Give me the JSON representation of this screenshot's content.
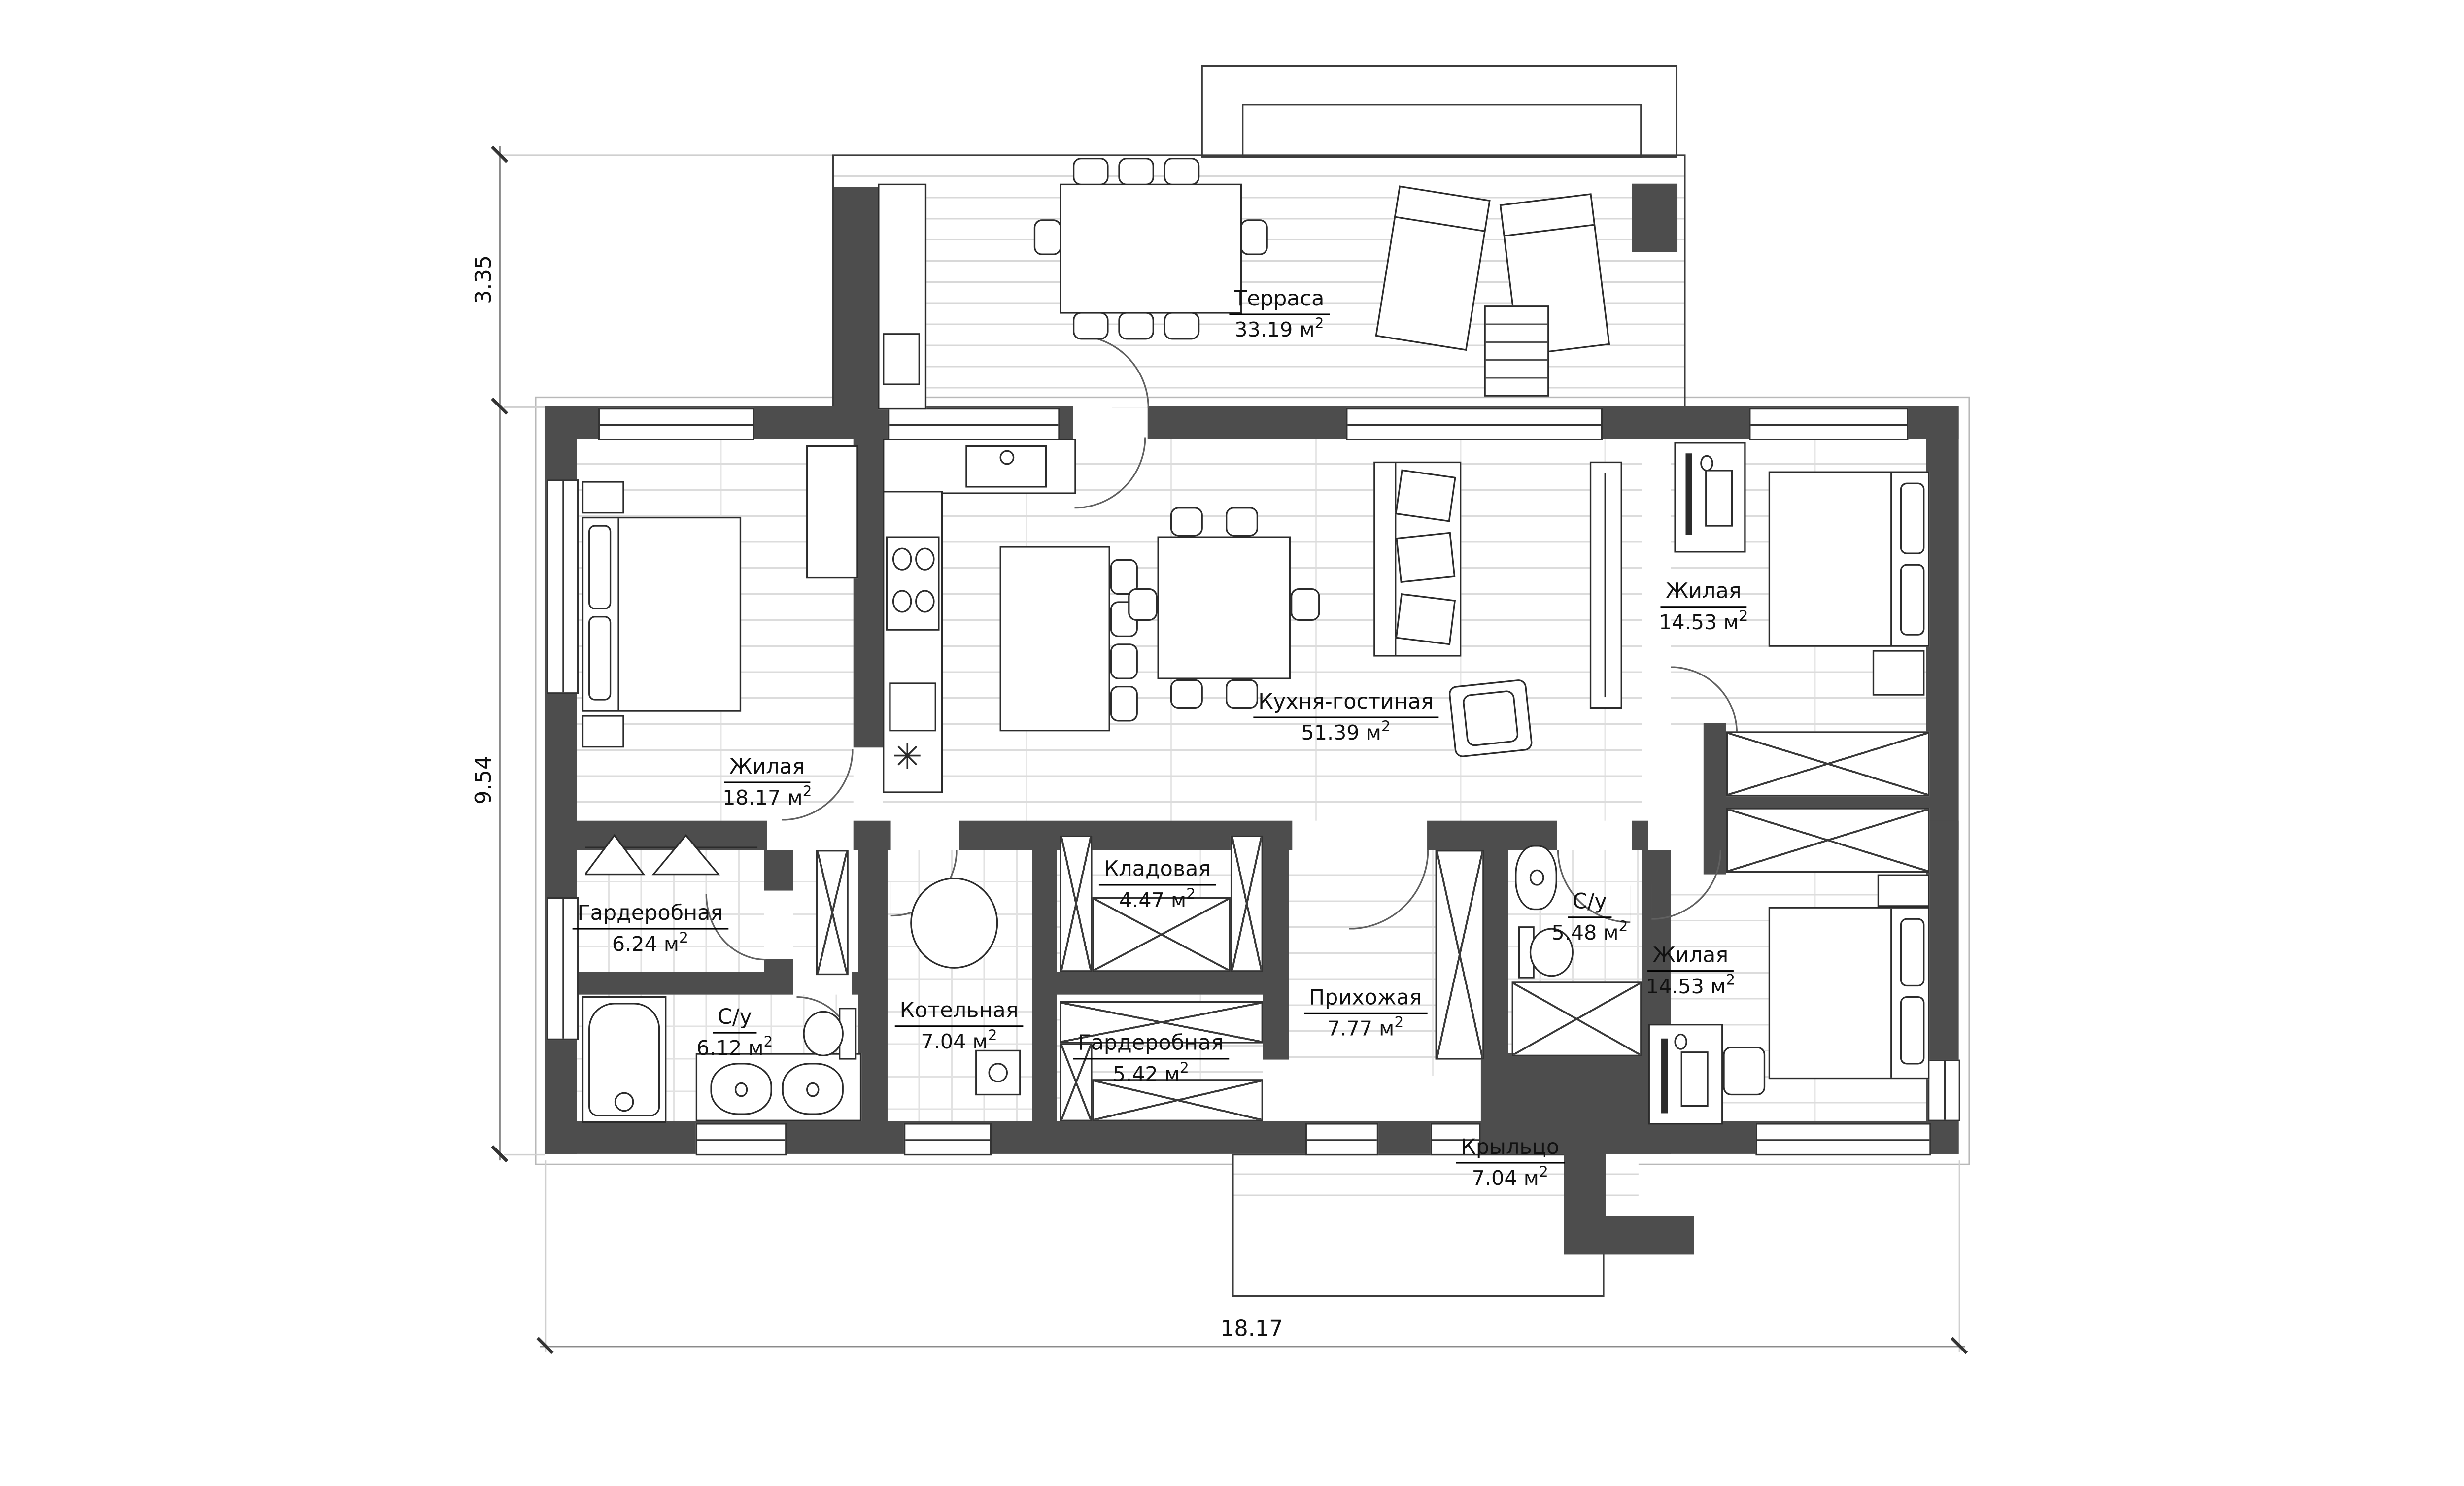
{
  "plan": {
    "title": "floor-plan",
    "units": {
      "area": "м",
      "sup": "2"
    },
    "rooms": [
      {
        "name": "Терраса",
        "area": "33.19"
      },
      {
        "name": "Кухня-гостиная",
        "area": "51.39"
      },
      {
        "name": "Жилая",
        "area": "18.17"
      },
      {
        "name": "Жилая",
        "area": "14.53"
      },
      {
        "name": "Жилая",
        "area": "14.53"
      },
      {
        "name": "Гардеробная",
        "area": "6.24"
      },
      {
        "name": "С/у",
        "area": "6.12"
      },
      {
        "name": "Котельная",
        "area": "7.04"
      },
      {
        "name": "Кладовая",
        "area": "4.47"
      },
      {
        "name": "Гардеробная",
        "area": "5.42"
      },
      {
        "name": "Прихожая",
        "area": "7.77"
      },
      {
        "name": "С/у",
        "area": "5.48"
      },
      {
        "name": "Крыльцо",
        "area": "7.04"
      }
    ],
    "dimensions": {
      "terrace_depth": "3.35",
      "house_depth": "9.54",
      "house_width": "18.17"
    },
    "icons": {
      "snowflake": "✳"
    },
    "colors": {
      "wall": "#4d4d4d",
      "outline": "#2b2b2b",
      "floor_line": "#dcdcdc"
    }
  }
}
